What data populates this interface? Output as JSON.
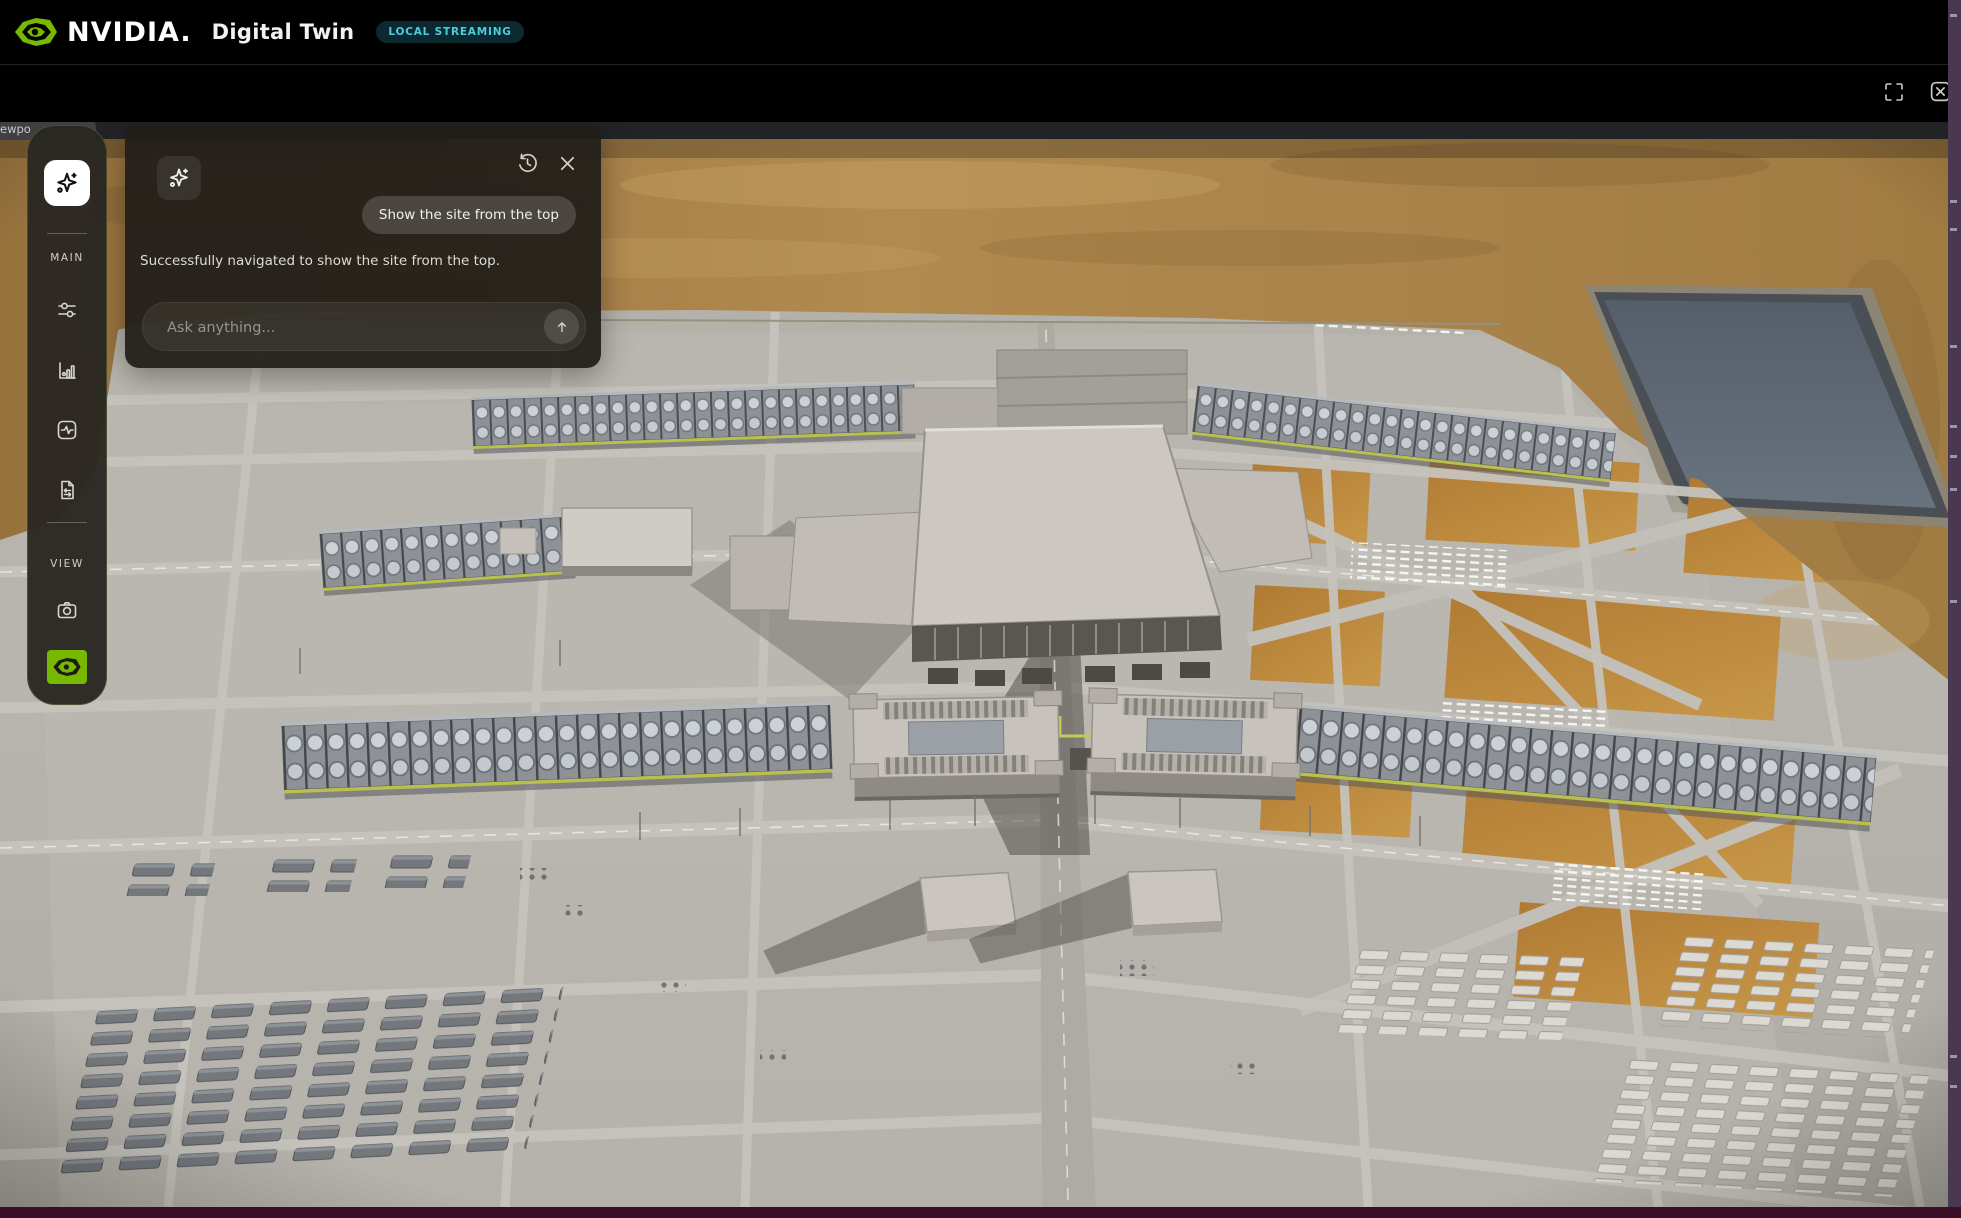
{
  "header": {
    "brand": "NVIDIA.",
    "title": "Digital Twin",
    "badge": "LOCAL STREAMING"
  },
  "viewport_tab": {
    "label": "ewpo"
  },
  "sidebar": {
    "sections": [
      {
        "label": "MAIN"
      },
      {
        "label": "VIEW"
      }
    ]
  },
  "chat": {
    "user_message": "Show the site from the top",
    "assistant_message": "Successfully navigated to show the site from the top.",
    "input_placeholder": "Ask anything..."
  },
  "colors": {
    "nvidia_green": "#76b900",
    "badge_text": "#4ecbe0",
    "badge_bg": "#0c2930",
    "right_strip": "#4a3852",
    "bottom_strip": "#3a0f26",
    "concrete": "#b5b2ac",
    "dirt": "#a37c44",
    "pond_water": "#5d6671"
  }
}
